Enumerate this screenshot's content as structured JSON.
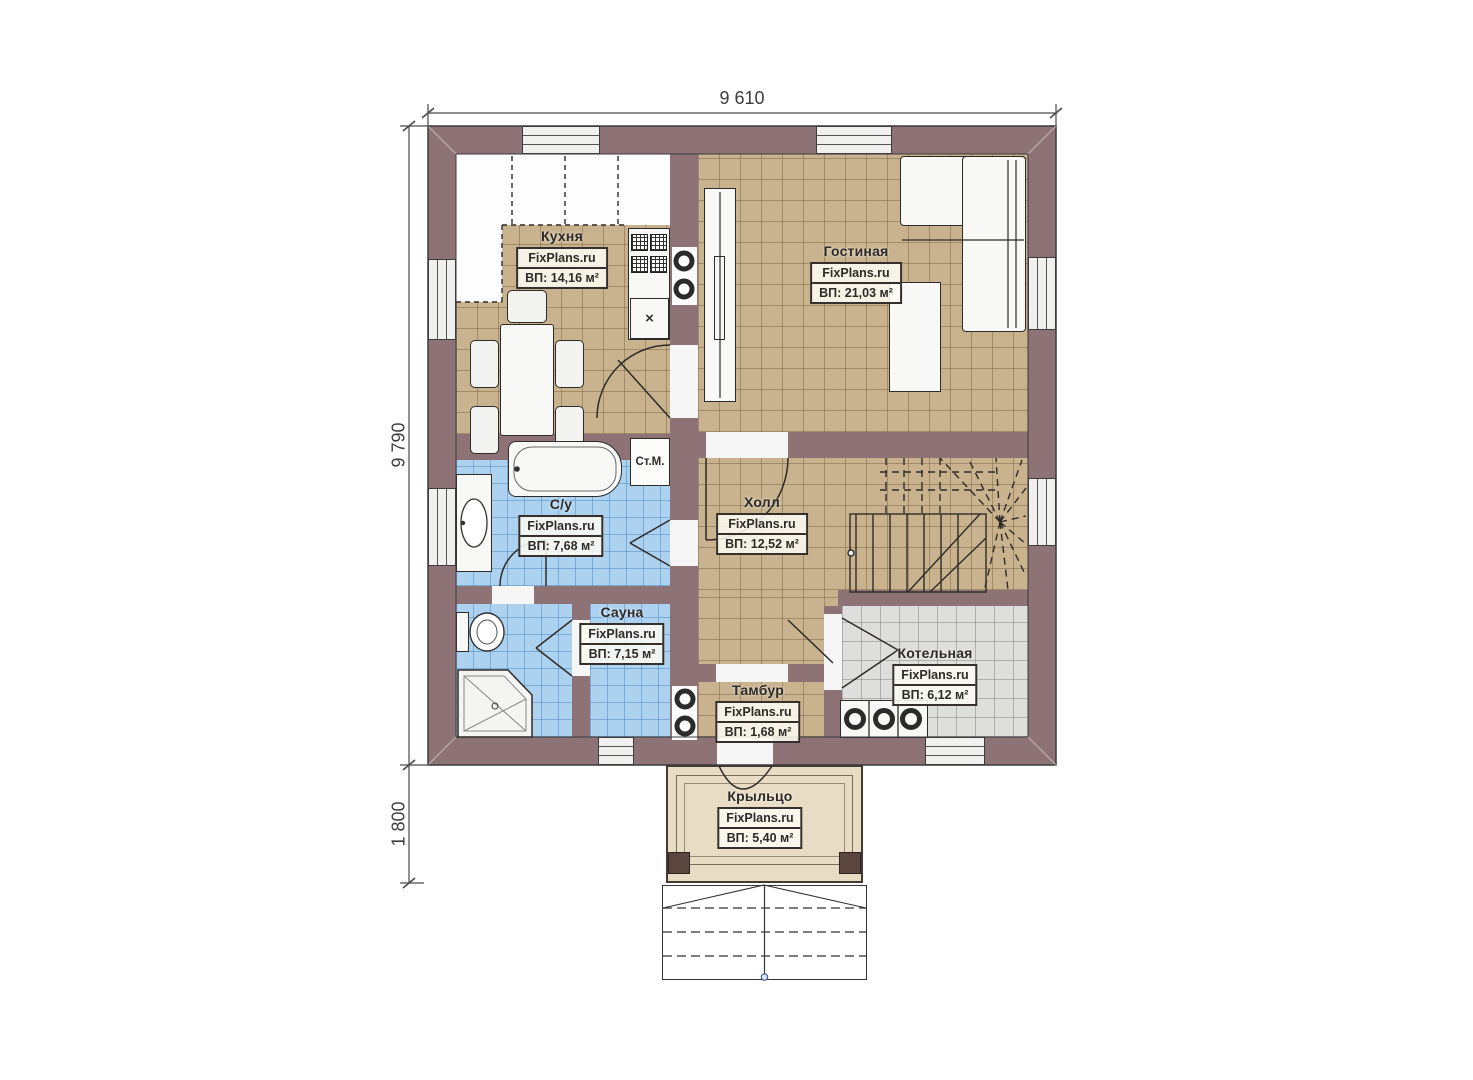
{
  "plan_title": "floor-plan-first-floor",
  "dimensions": {
    "width_total": "9 610",
    "height_total": "9 790",
    "porch_depth": "1 800"
  },
  "rooms": {
    "kitchen": {
      "name": "Кухня",
      "site": "FixPlans.ru",
      "area": "ВП: 14,16 м²"
    },
    "living": {
      "name": "Гостиная",
      "site": "FixPlans.ru",
      "area": "ВП: 21,03 м²"
    },
    "bathroom": {
      "name": "С/у",
      "site": "FixPlans.ru",
      "area": "ВП: 7,68 м²"
    },
    "hall": {
      "name": "Холл",
      "site": "FixPlans.ru",
      "area": "ВП: 12,52 м²"
    },
    "sauna": {
      "name": "Сауна",
      "site": "FixPlans.ru",
      "area": "ВП: 7,15 м²"
    },
    "tambur": {
      "name": "Тамбур",
      "site": "FixPlans.ru",
      "area": "ВП: 1,68 м²"
    },
    "boiler": {
      "name": "Котельная",
      "site": "FixPlans.ru",
      "area": "ВП: 6,12 м²"
    },
    "porch": {
      "name": "Крыльцо",
      "site": "FixPlans.ru",
      "area": "ВП: 5,40 м²"
    }
  },
  "labels": {
    "washing_machine": "Ст.М.",
    "sink_mark": "×"
  },
  "colors": {
    "wall": "#8d7276",
    "floor_wood": "#c9b38e",
    "floor_wet": "#acd2f0",
    "floor_boiler": "#dededd",
    "porch": "#e8dcc5",
    "line": "#2f2b28"
  }
}
